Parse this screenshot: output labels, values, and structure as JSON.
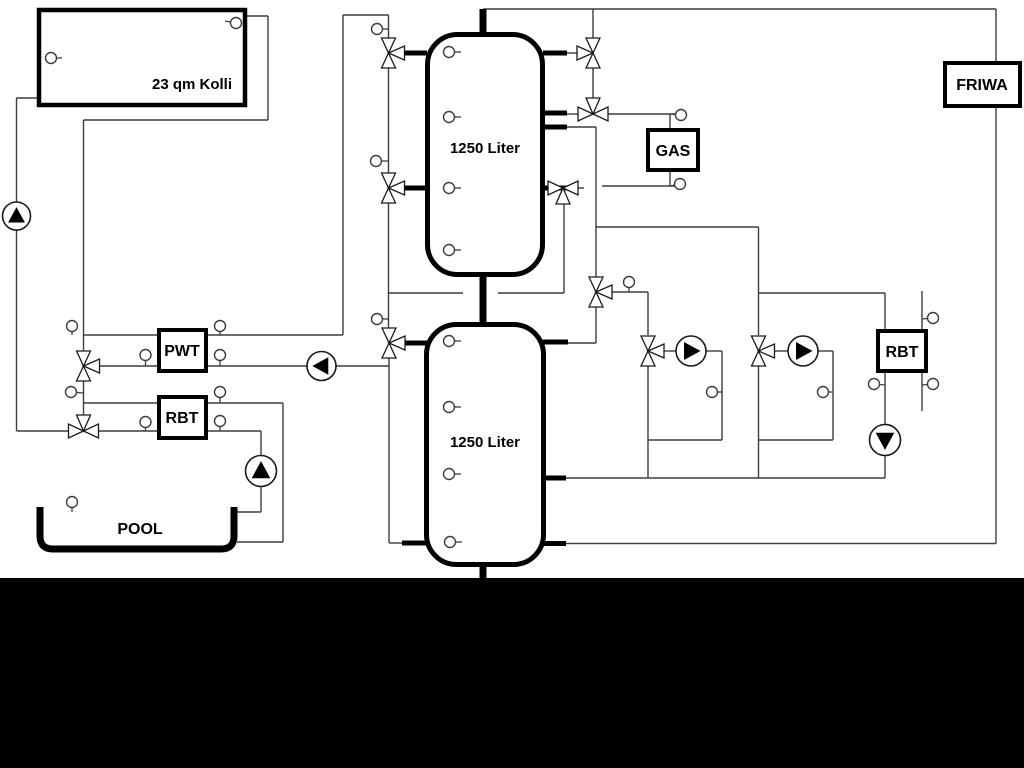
{
  "diagram": {
    "title": "heating-pool-solar-hydraulic-schematic",
    "colors": {
      "pipe": "#3d3d3d",
      "thick": "#000000",
      "background": "#ffffff",
      "bottom_bar": "#000000",
      "symbol_fill": "#ffffff",
      "symbol_stroke": "#1a1a1a"
    },
    "boxes": [
      {
        "name": "solar-collector",
        "label": "23 qm Kolli",
        "x": 39,
        "y": 10,
        "w": 206,
        "h": 95,
        "bw": 4.5,
        "lx": 192,
        "ly": 89,
        "fs": 15
      },
      {
        "name": "gas-boiler",
        "label": "GAS",
        "x": 648,
        "y": 130,
        "w": 50,
        "h": 40,
        "bw": 4,
        "lx": 673,
        "ly": 156,
        "fs": 16
      },
      {
        "name": "friwa-station",
        "label": "FRIWA",
        "x": 945,
        "y": 63,
        "w": 75,
        "h": 43,
        "bw": 4,
        "lx": 982,
        "ly": 90,
        "fs": 16
      },
      {
        "name": "pwt-heat-exchanger",
        "label": "PWT",
        "x": 159,
        "y": 330,
        "w": 47,
        "h": 41,
        "bw": 4,
        "lx": 182,
        "ly": 356,
        "fs": 16
      },
      {
        "name": "rbt-heat-exchanger-left",
        "label": "RBT",
        "x": 159,
        "y": 397,
        "w": 47,
        "h": 41,
        "bw": 4,
        "lx": 182,
        "ly": 423,
        "fs": 16
      },
      {
        "name": "rbt-heat-exchanger-right",
        "label": "RBT",
        "x": 878,
        "y": 331,
        "w": 48,
        "h": 40,
        "bw": 4,
        "lx": 902,
        "ly": 357,
        "fs": 16
      }
    ],
    "tanks": [
      {
        "name": "buffer-tank-top",
        "label": "1250 Liter",
        "x": 427.5,
        "y": 34.5,
        "w": 115,
        "h": 240,
        "rx": 30,
        "bw": 5,
        "lx": 485,
        "ly": 153,
        "fs": 15
      },
      {
        "name": "buffer-tank-bottom",
        "label": "1250 Liter",
        "x": 426.5,
        "y": 324.5,
        "w": 117,
        "h": 240,
        "rx": 30,
        "bw": 5,
        "lx": 485,
        "ly": 447,
        "fs": 15
      }
    ],
    "pool": {
      "name": "swimming-pool",
      "label": "POOL",
      "path": "M 40 507 L 40 536 Q 40 549 53 549 L 221 549 Q 234 549 234 536 L 234 507",
      "bw": 7,
      "lx": 140,
      "ly": 534,
      "fs": 16
    },
    "pipes_thin": [
      [
        247,
        16,
        268,
        16
      ],
      [
        268,
        16,
        268,
        120
      ],
      [
        268,
        120,
        83.5,
        120
      ],
      [
        83.5,
        120,
        83.5,
        351
      ],
      [
        83.5,
        381,
        83.5,
        415
      ],
      [
        83.5,
        335,
        159,
        335
      ],
      [
        206,
        335,
        343,
        335
      ],
      [
        343,
        335,
        343,
        15
      ],
      [
        343,
        15,
        388.5,
        15
      ],
      [
        388.5,
        15,
        388.5,
        38
      ],
      [
        99.5,
        366,
        159,
        366
      ],
      [
        206,
        366,
        307,
        366
      ],
      [
        336,
        366,
        389,
        366
      ],
      [
        83.5,
        403,
        159,
        403
      ],
      [
        206,
        403,
        283,
        403
      ],
      [
        283,
        403,
        283,
        542
      ],
      [
        283,
        542,
        237,
        542
      ],
      [
        16.5,
        98,
        37,
        98
      ],
      [
        16.5,
        98,
        16.5,
        202
      ],
      [
        16.5,
        230,
        16.5,
        431
      ],
      [
        16.5,
        431,
        68.5,
        431
      ],
      [
        98.5,
        431,
        159,
        431
      ],
      [
        206,
        431,
        261,
        431
      ],
      [
        261,
        431,
        261,
        455.5
      ],
      [
        261,
        486.5,
        261,
        512
      ],
      [
        261,
        512,
        237,
        512
      ],
      [
        388.5,
        68,
        388.5,
        173
      ],
      [
        388.5,
        203,
        388.5,
        328
      ],
      [
        388.5,
        293,
        463,
        293
      ],
      [
        389,
        358,
        389,
        543
      ],
      [
        389,
        543,
        403,
        543
      ],
      [
        498,
        293,
        564,
        293
      ],
      [
        564,
        293,
        564,
        204
      ],
      [
        567,
        53,
        577,
        53
      ],
      [
        593,
        9,
        593,
        38
      ],
      [
        593,
        68,
        593,
        98
      ],
      [
        567,
        114,
        578,
        114
      ],
      [
        608,
        114,
        676,
        114
      ],
      [
        670,
        114,
        670,
        130
      ],
      [
        670,
        170,
        670,
        186
      ],
      [
        602,
        186,
        676,
        186
      ],
      [
        578,
        188,
        584,
        188
      ],
      [
        567,
        127,
        596,
        127
      ],
      [
        596,
        127,
        596,
        277
      ],
      [
        596,
        227,
        758.5,
        227
      ],
      [
        758.5,
        227,
        758.5,
        335
      ],
      [
        758.5,
        293,
        885,
        293
      ],
      [
        885,
        293,
        885,
        331
      ],
      [
        612,
        292,
        648,
        292
      ],
      [
        648,
        292,
        648,
        335
      ],
      [
        596,
        307,
        596,
        343
      ],
      [
        596,
        343,
        568,
        343
      ],
      [
        664,
        351,
        676,
        351
      ],
      [
        706,
        351,
        722,
        351
      ],
      [
        722,
        351,
        722,
        440
      ],
      [
        722,
        440,
        648,
        440
      ],
      [
        648,
        366,
        648,
        478
      ],
      [
        774.5,
        351,
        788,
        351
      ],
      [
        818,
        351,
        833,
        351
      ],
      [
        833,
        351,
        833,
        440
      ],
      [
        833,
        440,
        758.5,
        440
      ],
      [
        758.5,
        366,
        758.5,
        478
      ],
      [
        566,
        478,
        885,
        478
      ],
      [
        885,
        478,
        885,
        455.5
      ],
      [
        885,
        424.5,
        885,
        373
      ],
      [
        922,
        291,
        922,
        329
      ],
      [
        922,
        373,
        922,
        411
      ],
      [
        483,
        9,
        996,
        9
      ],
      [
        996,
        9,
        996,
        63
      ],
      [
        996,
        106,
        996,
        543.5
      ],
      [
        996,
        543.5,
        566,
        543.5
      ]
    ],
    "pipes_stub": [
      [
        403,
        53,
        427,
        53
      ],
      [
        403,
        188,
        427,
        188
      ],
      [
        403,
        343,
        427,
        343
      ],
      [
        402,
        543,
        427,
        543
      ],
      [
        543,
        53,
        567,
        53
      ],
      [
        543,
        113,
        567,
        113
      ],
      [
        543,
        127,
        567,
        127
      ],
      [
        543,
        188,
        567,
        188
      ],
      [
        543,
        342,
        568,
        342
      ],
      [
        543,
        478,
        566,
        478
      ],
      [
        544,
        543.5,
        566,
        543.5
      ]
    ],
    "pipes_main": [
      [
        483,
        9,
        483,
        36
      ],
      [
        483,
        275,
        483,
        326
      ],
      [
        483,
        563,
        483,
        578
      ]
    ],
    "valves": [
      {
        "name": "valve-3way-solar-tank1-upper",
        "cx": 388.5,
        "cy": 53,
        "axis": "v",
        "branch": "right"
      },
      {
        "name": "valve-3way-tank1-lower-left",
        "cx": 388.5,
        "cy": 188,
        "axis": "v",
        "branch": "right"
      },
      {
        "name": "valve-3way-tank2-upper-left",
        "cx": 389,
        "cy": 343,
        "axis": "v",
        "branch": "right"
      },
      {
        "name": "valve-3way-tank1-upper-right",
        "cx": 593,
        "cy": 53,
        "axis": "v",
        "branch": "left"
      },
      {
        "name": "valve-3way-gas-supply",
        "cx": 593,
        "cy": 114,
        "axis": "h",
        "branch": "top"
      },
      {
        "name": "valve-3way-gas-return",
        "cx": 563,
        "cy": 188,
        "axis": "h",
        "branch": "bottom"
      },
      {
        "name": "valve-3way-distribution",
        "cx": 596,
        "cy": 292,
        "axis": "v",
        "branch": "right"
      },
      {
        "name": "valve-3way-heating-circuit-1",
        "cx": 648,
        "cy": 351,
        "axis": "v",
        "branch": "right"
      },
      {
        "name": "valve-3way-heating-circuit-2",
        "cx": 758.5,
        "cy": 351,
        "axis": "v",
        "branch": "right"
      },
      {
        "name": "valve-3way-pwt",
        "cx": 83.5,
        "cy": 366,
        "axis": "v",
        "branch": "right"
      },
      {
        "name": "valve-3way-pool-solar",
        "cx": 83.5,
        "cy": 431,
        "axis": "h",
        "branch": "top"
      }
    ],
    "pumps": [
      {
        "name": "solar-pump",
        "cx": 16.5,
        "cy": 216,
        "r": 14,
        "dir": "up"
      },
      {
        "name": "pwt-pump",
        "cx": 321.5,
        "cy": 366,
        "r": 14.5,
        "dir": "left"
      },
      {
        "name": "pool-pump",
        "cx": 261,
        "cy": 471,
        "r": 15.5,
        "dir": "up"
      },
      {
        "name": "heating-circuit-1-pump",
        "cx": 691,
        "cy": 351,
        "r": 15,
        "dir": "right"
      },
      {
        "name": "heating-circuit-2-pump",
        "cx": 803,
        "cy": 351,
        "r": 15,
        "dir": "right"
      },
      {
        "name": "rbt-right-pump",
        "cx": 885,
        "cy": 440,
        "r": 15.5,
        "dir": "down"
      }
    ],
    "sensors": [
      [
        51,
        58,
        62,
        58
      ],
      [
        236,
        23,
        225,
        21
      ],
      [
        377,
        29,
        388.5,
        29
      ],
      [
        376,
        161,
        388.5,
        161
      ],
      [
        377,
        319,
        389,
        319
      ],
      [
        449,
        52,
        461,
        52
      ],
      [
        449,
        117,
        461,
        117
      ],
      [
        449,
        188,
        461,
        188
      ],
      [
        449,
        250,
        461,
        250
      ],
      [
        449,
        341,
        461,
        341
      ],
      [
        449,
        407,
        461,
        407
      ],
      [
        449,
        474,
        461,
        474
      ],
      [
        450,
        542,
        462,
        542
      ],
      [
        629,
        282,
        629,
        292
      ],
      [
        681,
        115,
        670,
        114
      ],
      [
        680,
        184,
        670,
        186
      ],
      [
        712,
        392,
        722,
        392
      ],
      [
        823,
        392,
        833,
        392
      ],
      [
        874,
        384,
        885,
        385
      ],
      [
        933,
        318,
        922,
        319
      ],
      [
        933,
        384,
        922,
        385
      ],
      [
        72,
        326,
        72,
        335
      ],
      [
        220,
        326,
        220,
        335
      ],
      [
        145.5,
        355,
        145.5,
        366
      ],
      [
        220,
        355,
        220,
        366
      ],
      [
        71,
        392,
        83.5,
        393
      ],
      [
        145.5,
        422,
        145.5,
        431
      ],
      [
        220,
        392,
        220,
        403
      ],
      [
        220,
        421,
        220,
        431
      ],
      [
        72,
        502,
        72,
        512
      ]
    ],
    "bottom_bar": {
      "x": 0,
      "y": 578,
      "w": 1024,
      "h": 190
    }
  }
}
